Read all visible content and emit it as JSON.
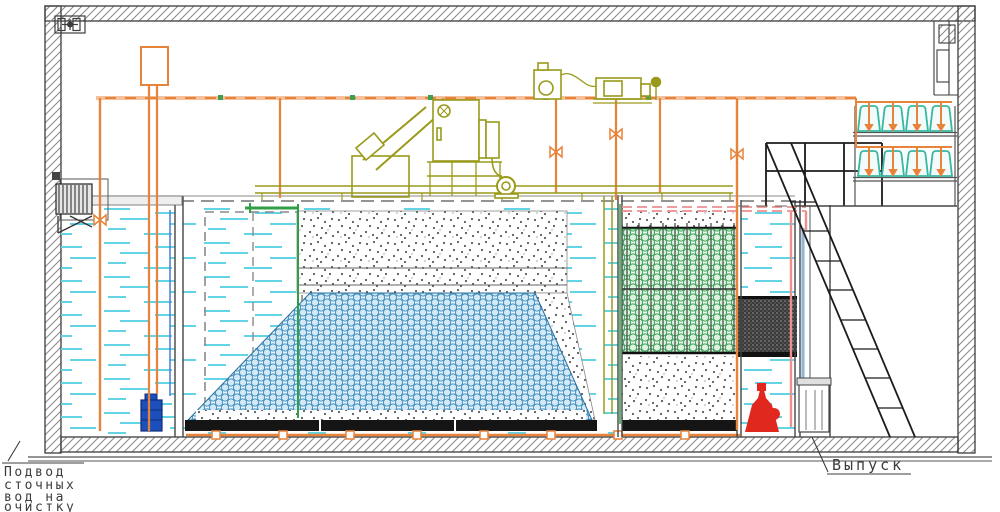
{
  "drawing": {
    "type": "wastewater-treatment-plant-cross-section",
    "labels": {
      "inlet": [
        "Подвод",
        "сточных",
        "вод на",
        "очистку"
      ],
      "outlet": "Выпуск"
    },
    "colors": {
      "pipe_orange": "#e8833a",
      "equipment_olive": "#9a9a1a",
      "water_cyan": "#62d4e6",
      "media_blue": "#4090c0",
      "media_green": "#3aa055",
      "dosing_tank_teal": "#35b8a0",
      "pump_red": "#e0281e",
      "pump_blue": "#1d4fba",
      "pipe_pink": "#ef8f8f",
      "structure_dark": "#3c3c3c"
    },
    "components": [
      "building-shell",
      "ventilation-icon",
      "inlet-screen",
      "inlet-chamber",
      "aeration-tank",
      "granular-media-bed",
      "floating-media-layer",
      "biofilter-tank",
      "lamella-module",
      "clarifier-tank",
      "outlet-channel",
      "screw-press",
      "blower-units",
      "service-walkway",
      "dosing-tanks",
      "access-stairs",
      "platform-railing",
      "submersible-pump-blue",
      "outlet-pump-red"
    ]
  }
}
